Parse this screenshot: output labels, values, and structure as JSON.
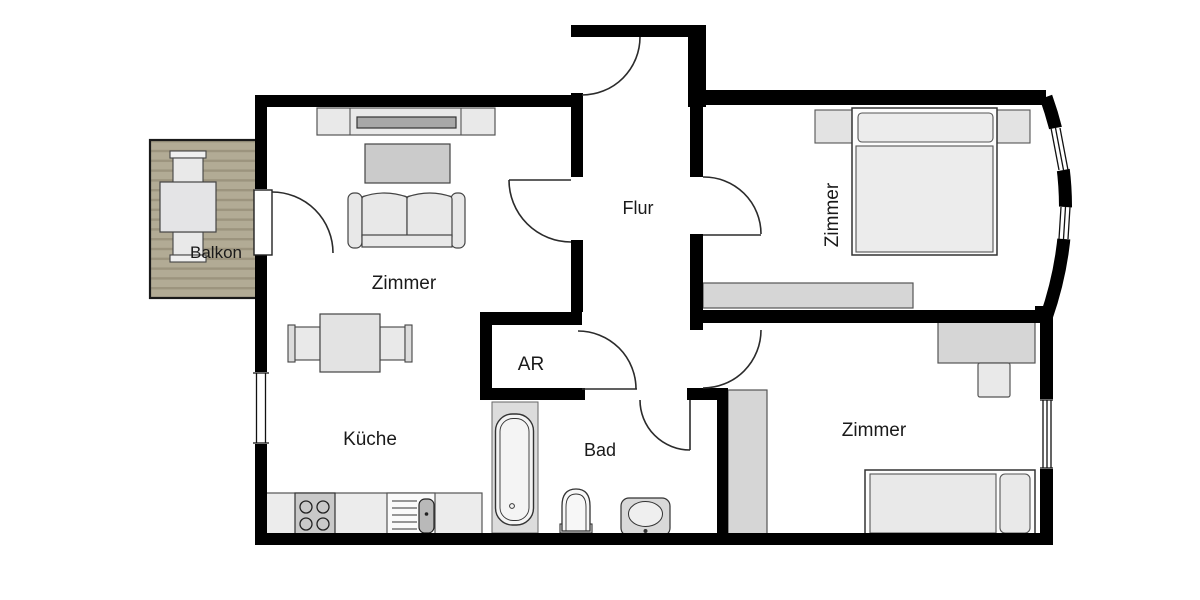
{
  "plan": {
    "type": "apartment-floorplan",
    "rooms": [
      {
        "id": "balkon",
        "label": "Balkon"
      },
      {
        "id": "wohnzimmer",
        "label": "Zimmer"
      },
      {
        "id": "flur",
        "label": "Flur"
      },
      {
        "id": "schlafzimmer",
        "label": "Zimmer"
      },
      {
        "id": "abstellraum",
        "label": "AR"
      },
      {
        "id": "kueche",
        "label": "Küche"
      },
      {
        "id": "bad",
        "label": "Bad"
      },
      {
        "id": "zimmer_unten",
        "label": "Zimmer"
      }
    ],
    "colors": {
      "wall": "#000000",
      "background": "#ffffff",
      "furniture_light": "#e8e8e8",
      "furniture_mid": "#cccccc",
      "tv_screen": "#a8a8a8",
      "balcony_deck": "#b2ab95",
      "balcony_deck_stripe": "#9c947e",
      "door_arc": "#2b2b2b"
    }
  }
}
